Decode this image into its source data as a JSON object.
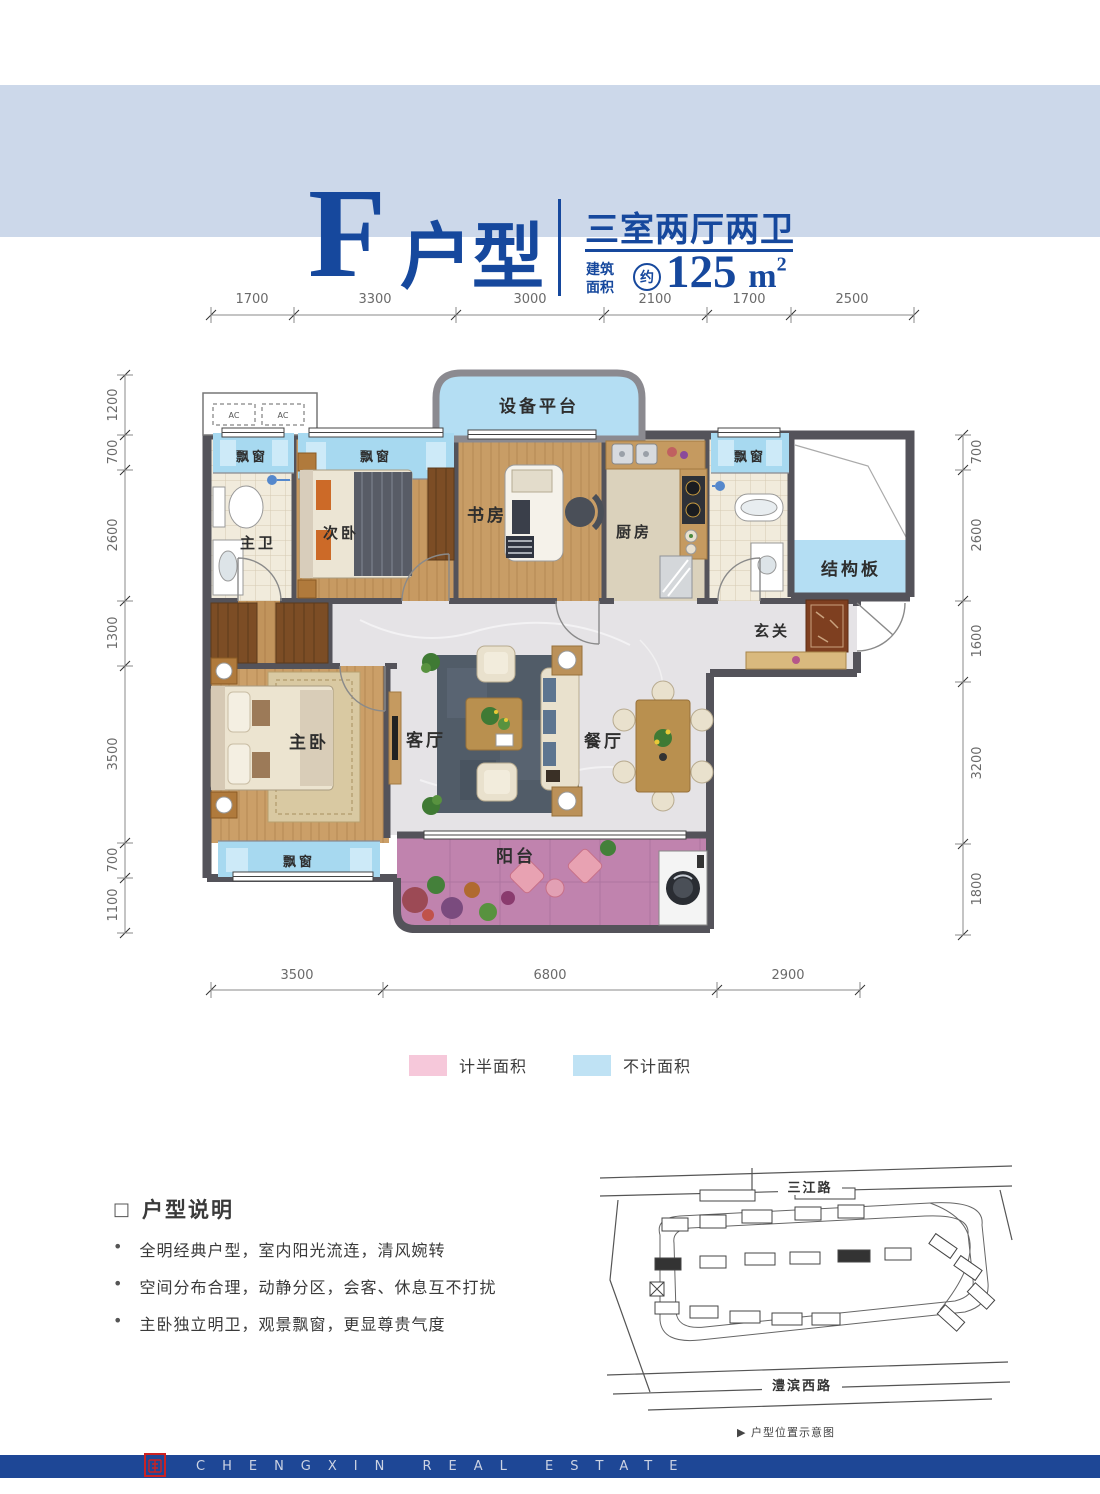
{
  "header": {
    "unit_letter": "F",
    "unit_suffix": "户型",
    "layout": "三室两厅两卫",
    "area_label_line1": "建筑",
    "area_label_line2": "面积",
    "area_approx": "约",
    "area_value": "125",
    "area_unit": "m",
    "area_unit_sup": "2"
  },
  "plan": {
    "rooms": {
      "equipment_platform": "设备平台",
      "bay_window": "飘窗",
      "master_bath": "主卫",
      "second_bedroom": "次卧",
      "study": "书房",
      "kitchen": "厨房",
      "structural_slab": "结构板",
      "foyer": "玄关",
      "master_bedroom": "主卧",
      "living_room": "客厅",
      "dining_room": "餐厅",
      "balcony": "阳台",
      "ac_unit": "AC"
    },
    "dimensions": {
      "top": [
        "1700",
        "3300",
        "3000",
        "2100",
        "1700",
        "2500"
      ],
      "left": [
        "1200",
        "700",
        "2600",
        "1300",
        "3500",
        "700",
        "1100"
      ],
      "right": [
        "700",
        "2600",
        "1600",
        "3200",
        "1800"
      ],
      "bottom": [
        "3500",
        "6800",
        "2900"
      ]
    }
  },
  "legend": {
    "half_area": {
      "label": "计半面积",
      "color": "#f6c8da"
    },
    "excluded_area": {
      "label": "不计面积",
      "color": "#bfe2f4"
    }
  },
  "description": {
    "title_marker": "□",
    "title": "户型说明",
    "bullet_marker": "•",
    "bullets": [
      "全明经典户型，室内阳光流连，清风婉转",
      "空间分布合理，动静分区，会客、休息互不打扰",
      "主卧独立明卫，观景飘窗，更显尊贵气度"
    ]
  },
  "site_map": {
    "road_top": "三江路",
    "road_bottom": "澧滨西路",
    "caption_marker": "▶",
    "caption": "户型位置示意图"
  },
  "footer": {
    "brand_text": "CHENGXIN REAL ESTATE"
  },
  "colors": {
    "header_band": "#ccd8ea",
    "brand_blue": "#16489d",
    "wall_gray": "#54535a",
    "bay_window_blue": "#a7d9f0",
    "platform_blue": "#b4def3",
    "balcony_pink": "#c083ae",
    "legend_pink": "#f6c8da",
    "legend_blue": "#bfe2f4",
    "footer_blue": "#1e4796",
    "seal_red": "#cc2222"
  }
}
